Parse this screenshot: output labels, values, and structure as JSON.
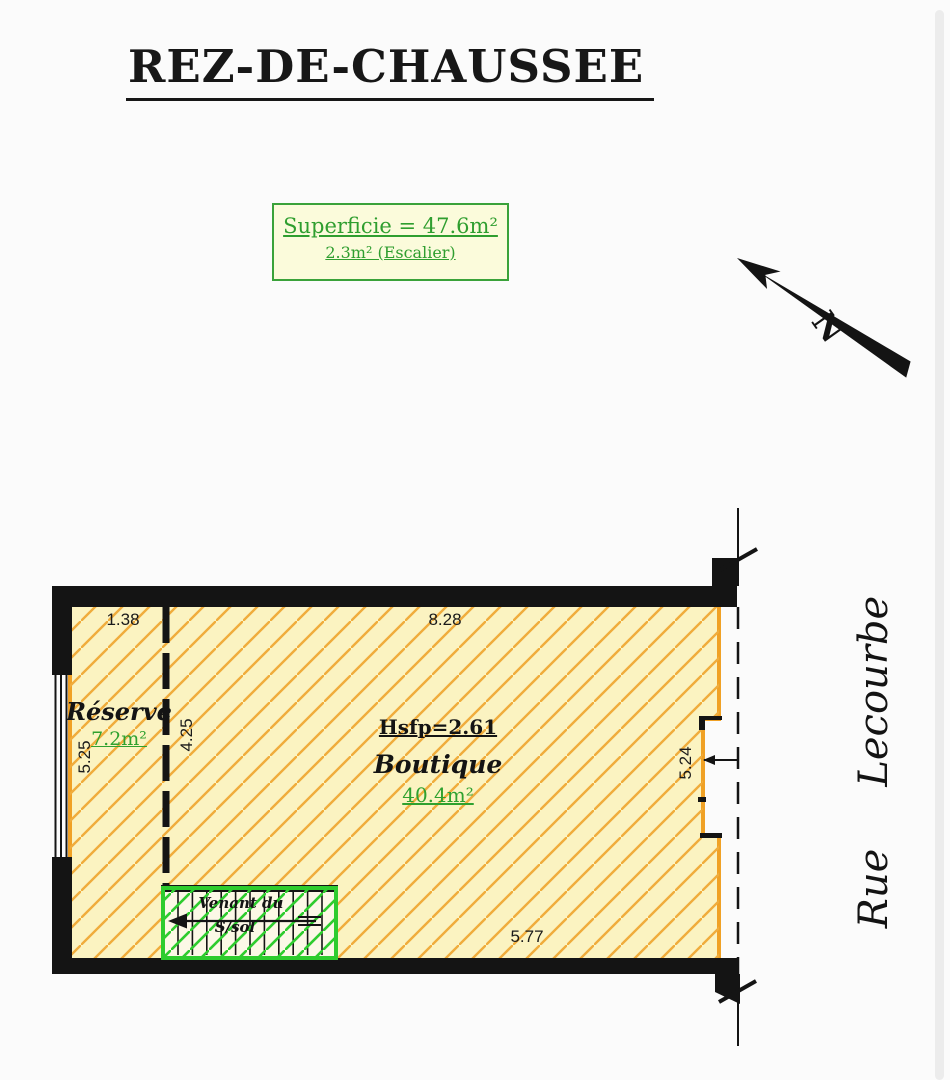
{
  "title": "REZ-DE-CHAUSSEE",
  "area_box": {
    "line1": "Superficie = 47.6m²",
    "line2": "2.3m² (Escalier)",
    "text_color": "#2f9e2f",
    "border_color": "#3aa23a",
    "background": "#fbfbdb"
  },
  "compass": {
    "label": "N"
  },
  "plan": {
    "rooms": [
      {
        "name": "Réserve",
        "area": "7.2m²"
      },
      {
        "name": "Boutique",
        "area": "40.4m²",
        "height_note": "Hsfp=2.61"
      }
    ],
    "stair": {
      "label_line1": "Venant du",
      "label_line2": "S/sol"
    },
    "dimensions": {
      "top_left": "1.38",
      "top": "8.28",
      "left": "5.25",
      "partition": "4.25",
      "right": "5.24",
      "bottom": "5.77"
    },
    "colors": {
      "room_fill": "#fbf3c1",
      "hatch": "#f0ac3c",
      "room_border": "#f0a125",
      "wall": "#141414",
      "stair_green": "#2ecc2e",
      "area_text_green": "#2fa12f"
    }
  },
  "street": {
    "word1": "Rue",
    "word2": "Lecourbe"
  }
}
